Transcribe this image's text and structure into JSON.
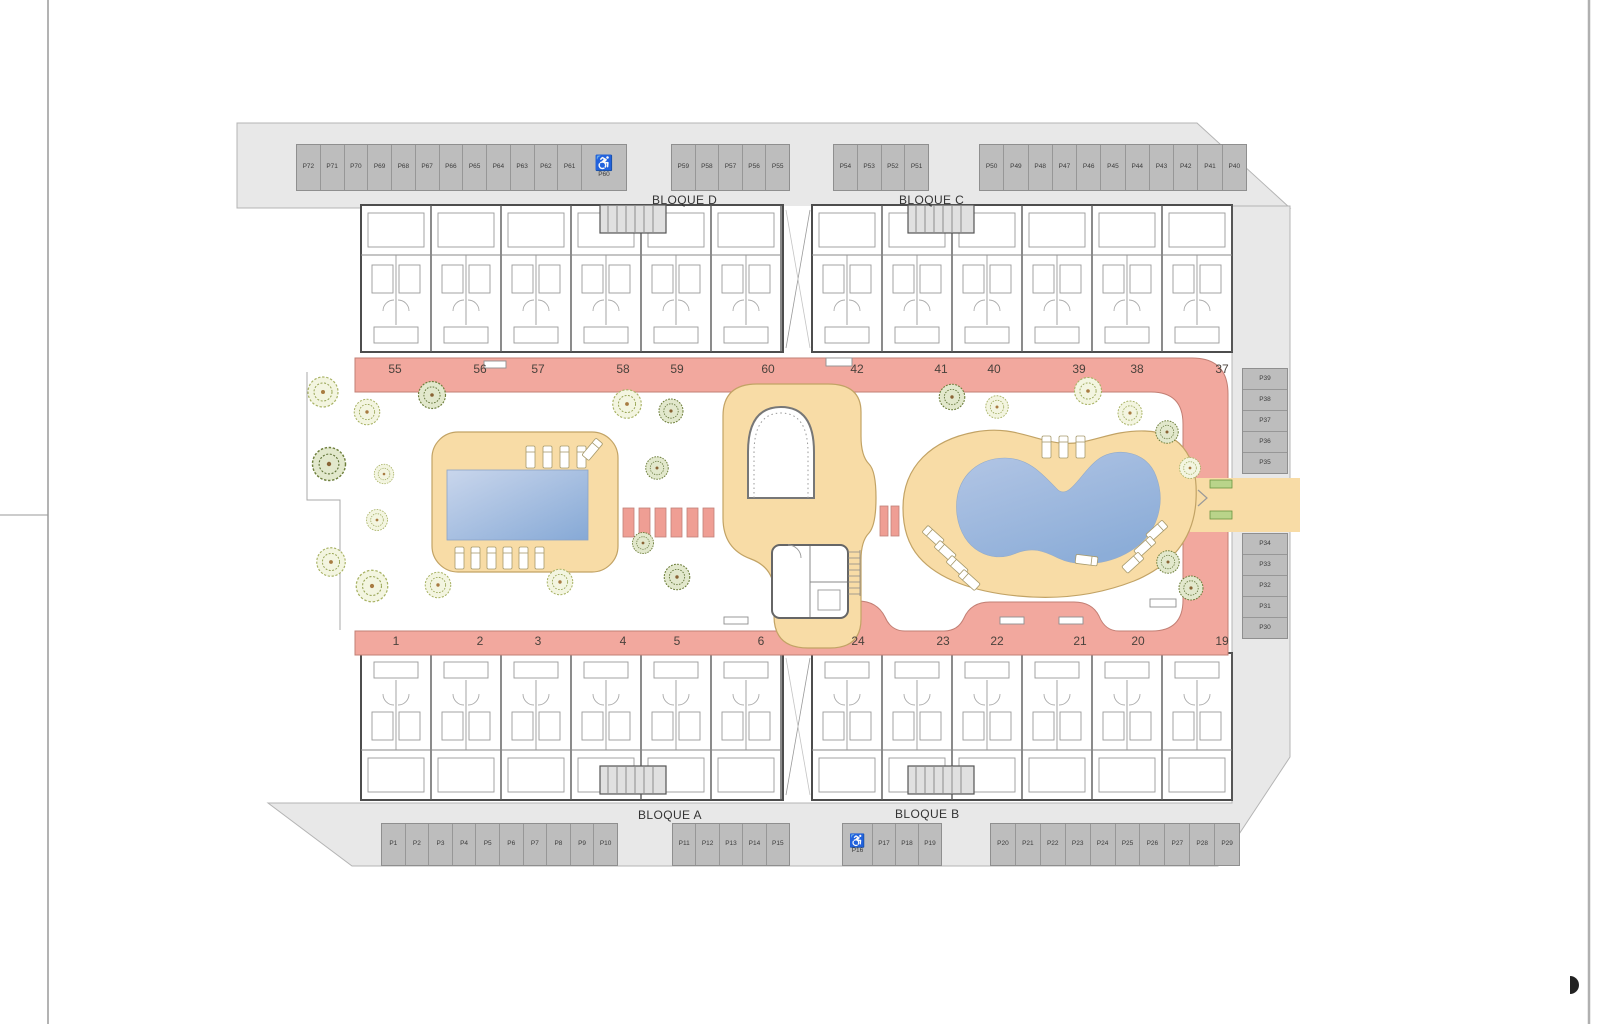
{
  "plan": {
    "blocks": {
      "d": "BLOQUE D",
      "c": "BLOQUE C",
      "a": "BLOQUE A",
      "b": "BLOQUE B"
    },
    "handicap_symbol": "♿",
    "parking": {
      "top_left": [
        "P72",
        "P71",
        "P70",
        "P69",
        "P68",
        "P67",
        "P66",
        "P65",
        "P64",
        "P63",
        "P62",
        "P61"
      ],
      "top_left_handicap": "P60",
      "top_mid1": [
        "P59",
        "P58",
        "P57",
        "P56",
        "P55"
      ],
      "top_mid2": [
        "P54",
        "P53",
        "P52",
        "P51"
      ],
      "top_right": [
        "P50",
        "P49",
        "P48",
        "P47",
        "P46",
        "P45",
        "P44",
        "P43",
        "P42",
        "P41",
        "P40"
      ],
      "right_upper": [
        "P39",
        "P38",
        "P37",
        "P36",
        "P35"
      ],
      "right_lower": [
        "P34",
        "P33",
        "P32",
        "P31",
        "P30"
      ],
      "bottom_left": [
        "P1",
        "P2",
        "P3",
        "P4",
        "P5",
        "P6",
        "P7",
        "P8",
        "P9",
        "P10"
      ],
      "bottom_mid": [
        "P11",
        "P12",
        "P13",
        "P14",
        "P15"
      ],
      "bottom_handicap": "P16",
      "bottom_after_handicap": [
        "P17",
        "P18",
        "P19"
      ],
      "bottom_right": [
        "P20",
        "P21",
        "P22",
        "P23",
        "P24",
        "P25",
        "P26",
        "P27",
        "P28",
        "P29"
      ]
    },
    "units": {
      "top_left": [
        "55",
        "56",
        "57",
        "58",
        "59",
        "60"
      ],
      "top_right": [
        "42",
        "41",
        "40",
        "39",
        "38",
        "37"
      ],
      "bottom_left": [
        "1",
        "2",
        "3",
        "4",
        "5",
        "6"
      ],
      "bottom_right": [
        "24",
        "23",
        "22",
        "21",
        "20",
        "19"
      ]
    },
    "colors": {
      "site": "#e8e8e8",
      "stall": "#bdbdbd",
      "stall_border": "#8f8f8f",
      "walkway": "#f2a89e",
      "walkway_edge": "#c27f74",
      "deck": "#f8dca6",
      "deck_edge": "#c2a365",
      "pool_light": "#c9d6ec",
      "pool_dark": "#8cadd8",
      "tree_light": "#a8b264",
      "tree_dark": "#6e7f3c",
      "wall": "#4d4d4d"
    }
  }
}
